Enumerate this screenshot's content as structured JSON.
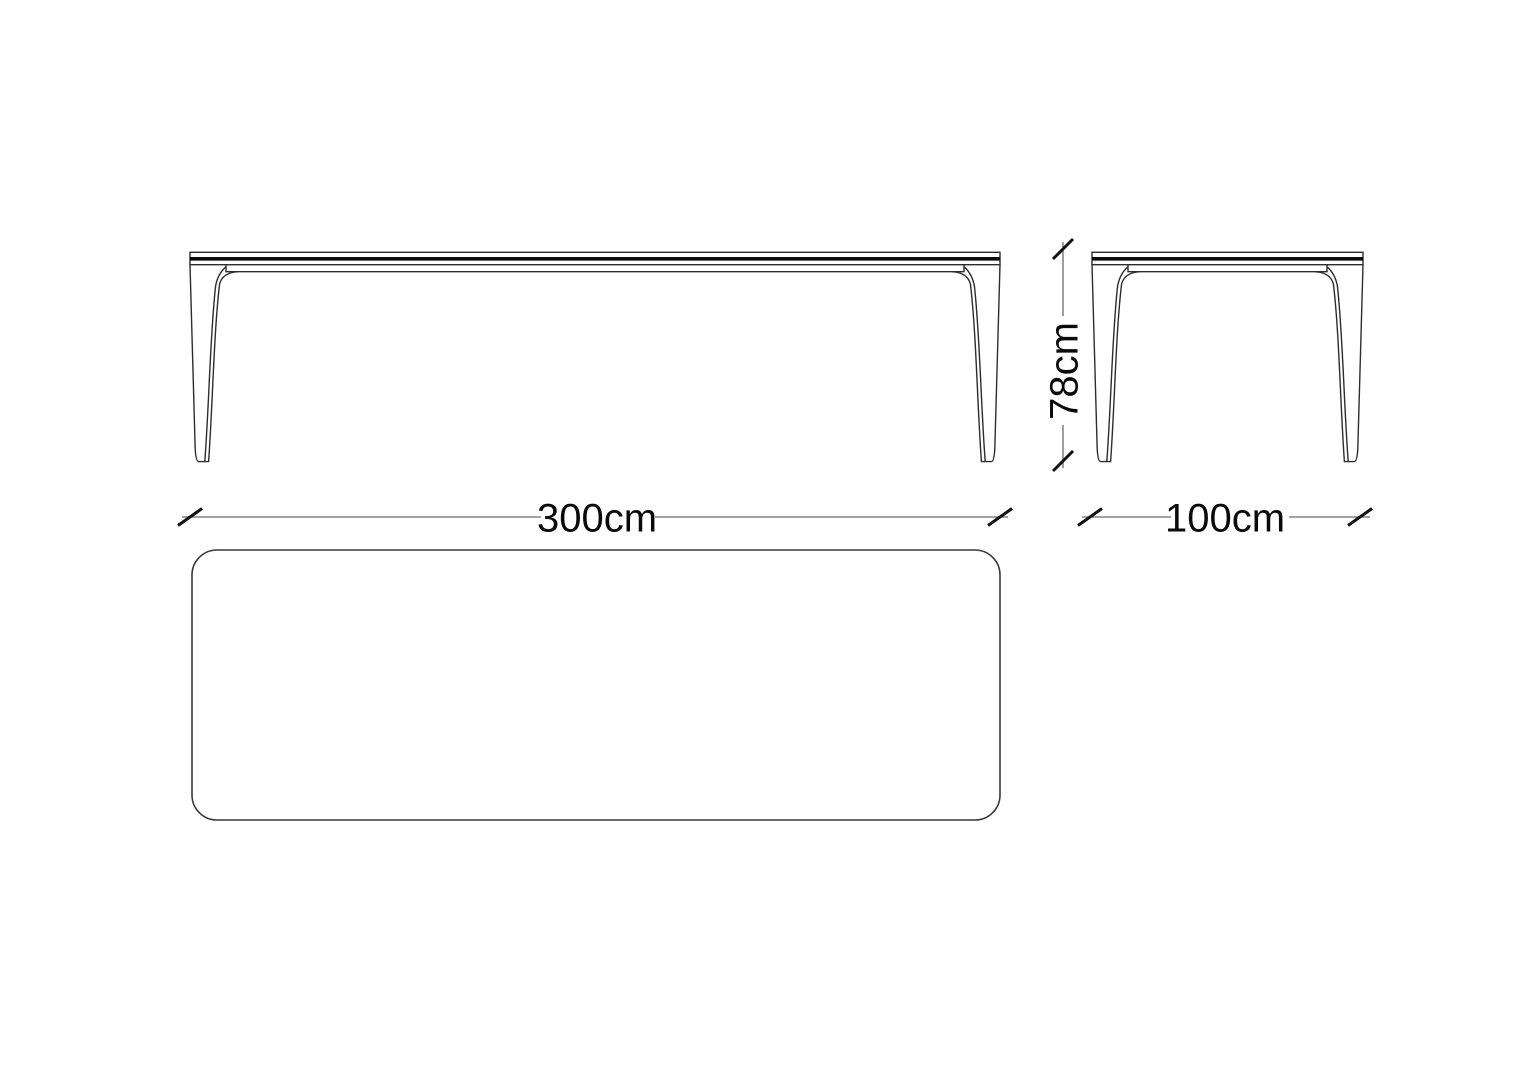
{
  "drawing": {
    "type": "furniture-dimension-drawing",
    "subject": "table",
    "background": "#ffffff",
    "dimensions": {
      "width": {
        "label": "300cm",
        "value": 300,
        "unit": "cm"
      },
      "depth": {
        "label": "100cm",
        "value": 100,
        "unit": "cm"
      },
      "height": {
        "label": "78cm",
        "value": 78,
        "unit": "cm"
      }
    },
    "colors": {
      "outline": "#2d2d2d",
      "tabletop_edge": "#0a0a0a",
      "dimension_line": "#6b6b6b",
      "tick": "#111111",
      "text": "#0a0a0a"
    }
  }
}
